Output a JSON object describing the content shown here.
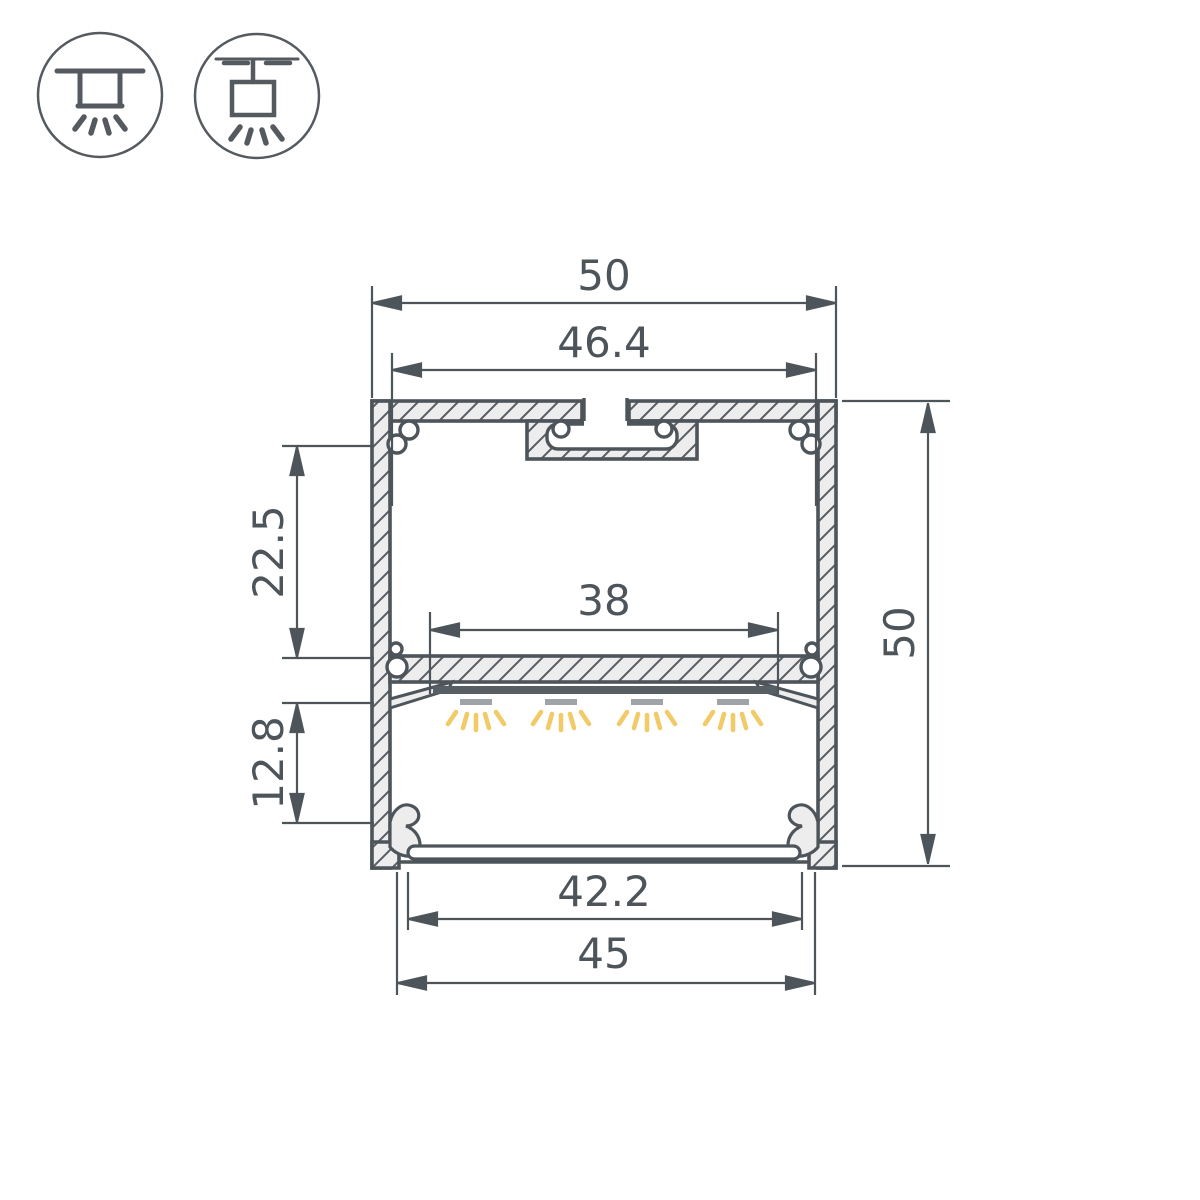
{
  "drawing": {
    "title": "aluminium-led-profile-cross-section",
    "mount_icons": [
      {
        "id": "surface-mount-icon",
        "meaning": "surface ceiling mount luminaire"
      },
      {
        "id": "suspended-mount-icon",
        "meaning": "suspended pendant mount luminaire"
      }
    ],
    "dimensions": {
      "outer_width": "50",
      "top_inner_width": "46.4",
      "led_platform_width": "38",
      "upper_chamber_height": "22.5",
      "lower_chamber_height": "12.8",
      "outer_height": "50",
      "diffuser_width": "42.2",
      "bottom_width": "45"
    },
    "colors": {
      "line": "#4d545a",
      "body_fill": "#ededee",
      "hatch_stroke": "#565c61",
      "led_strip": "#575e64",
      "led_module": "#9fa4a8",
      "light_ray": "#f2cb69",
      "background": "#ffffff"
    }
  }
}
